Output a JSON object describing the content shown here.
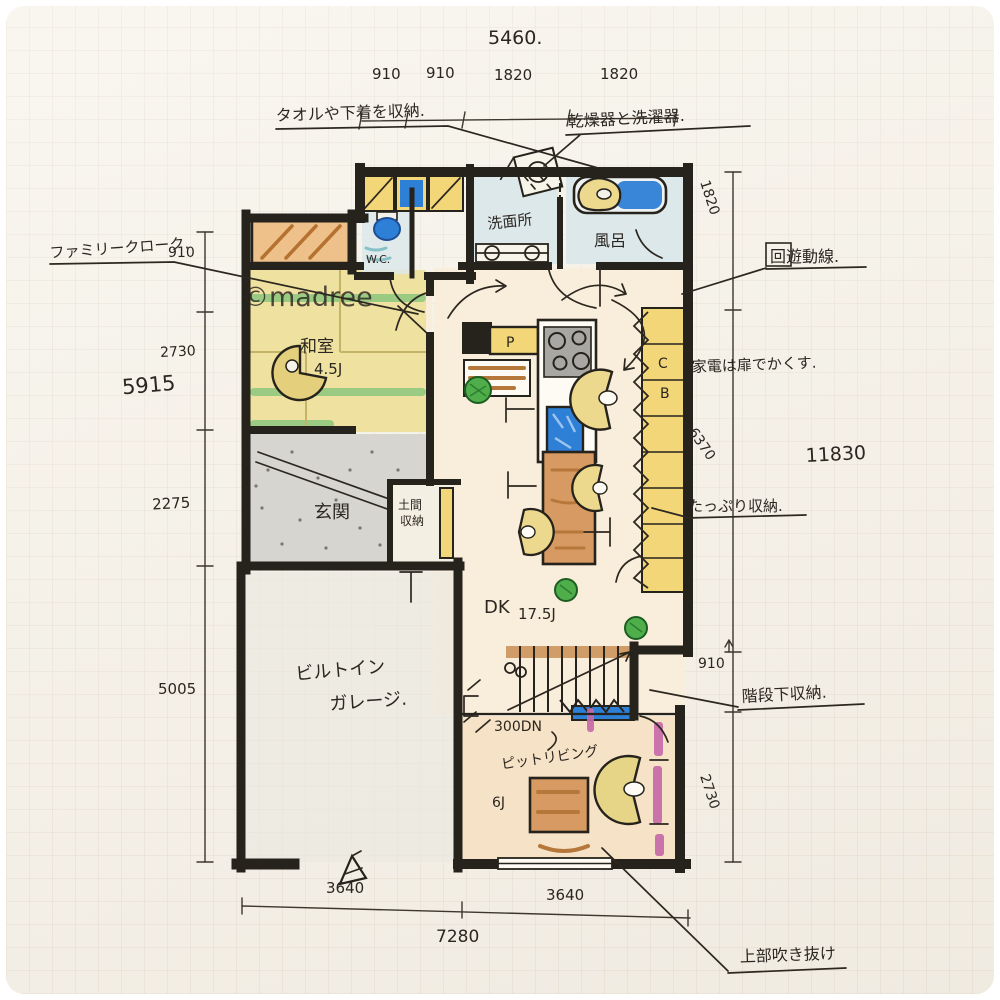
{
  "watermark": "©madree",
  "dimensions": {
    "top": {
      "total": "5460.",
      "seg1": "910",
      "seg2": "910",
      "seg3": "1820",
      "seg4": "1820"
    },
    "left": {
      "seg1": "910",
      "seg2": "2730",
      "seg3": "2275",
      "seg4": "5005",
      "total": "5915"
    },
    "right": {
      "seg1": "1820",
      "seg2": "6370",
      "seg3": "910",
      "seg4": "2730",
      "total": "11830"
    },
    "bottom": {
      "seg1": "3640",
      "seg2": "3640",
      "total": "7280"
    }
  },
  "annotations": {
    "towel_storage": "タオルや下着を収納.",
    "dryer_washer": "乾燥器と洗濯器.",
    "family_cloak": "ファミリークローク.",
    "circulation": "回遊動線.",
    "hide_appliances": "家電は扉でかくす.",
    "ample_storage": "たっぷり収納.",
    "under_stair_storage": "階段下収納.",
    "void_above": "上部吹き抜け"
  },
  "rooms": {
    "wc": "W.C.",
    "washroom": "洗面所",
    "bath": "風呂",
    "tatami_room": "和室",
    "tatami_size": "4.5J",
    "entrance": "玄関",
    "doma_line1": "土間",
    "doma_line2": "収納",
    "garage_line1": "ビルトイン",
    "garage_line2": "ガレージ.",
    "dk": "DK",
    "dk_size": "17.5J",
    "step_down": "300DN",
    "pit_living": "ピットリビング",
    "pit_living_size": "6J",
    "pantry_label": "P",
    "cupboard_c": "C",
    "cupboard_b": "B"
  },
  "colors": {
    "wall": "#26221c",
    "accent_blue": "#2e7fd6",
    "cabinet_yellow": "#f2d678",
    "wood_brown": "#d79a62",
    "tatami_green": "#86c57c",
    "magenta": "#c668a8",
    "plant_green": "#4fae4a"
  }
}
